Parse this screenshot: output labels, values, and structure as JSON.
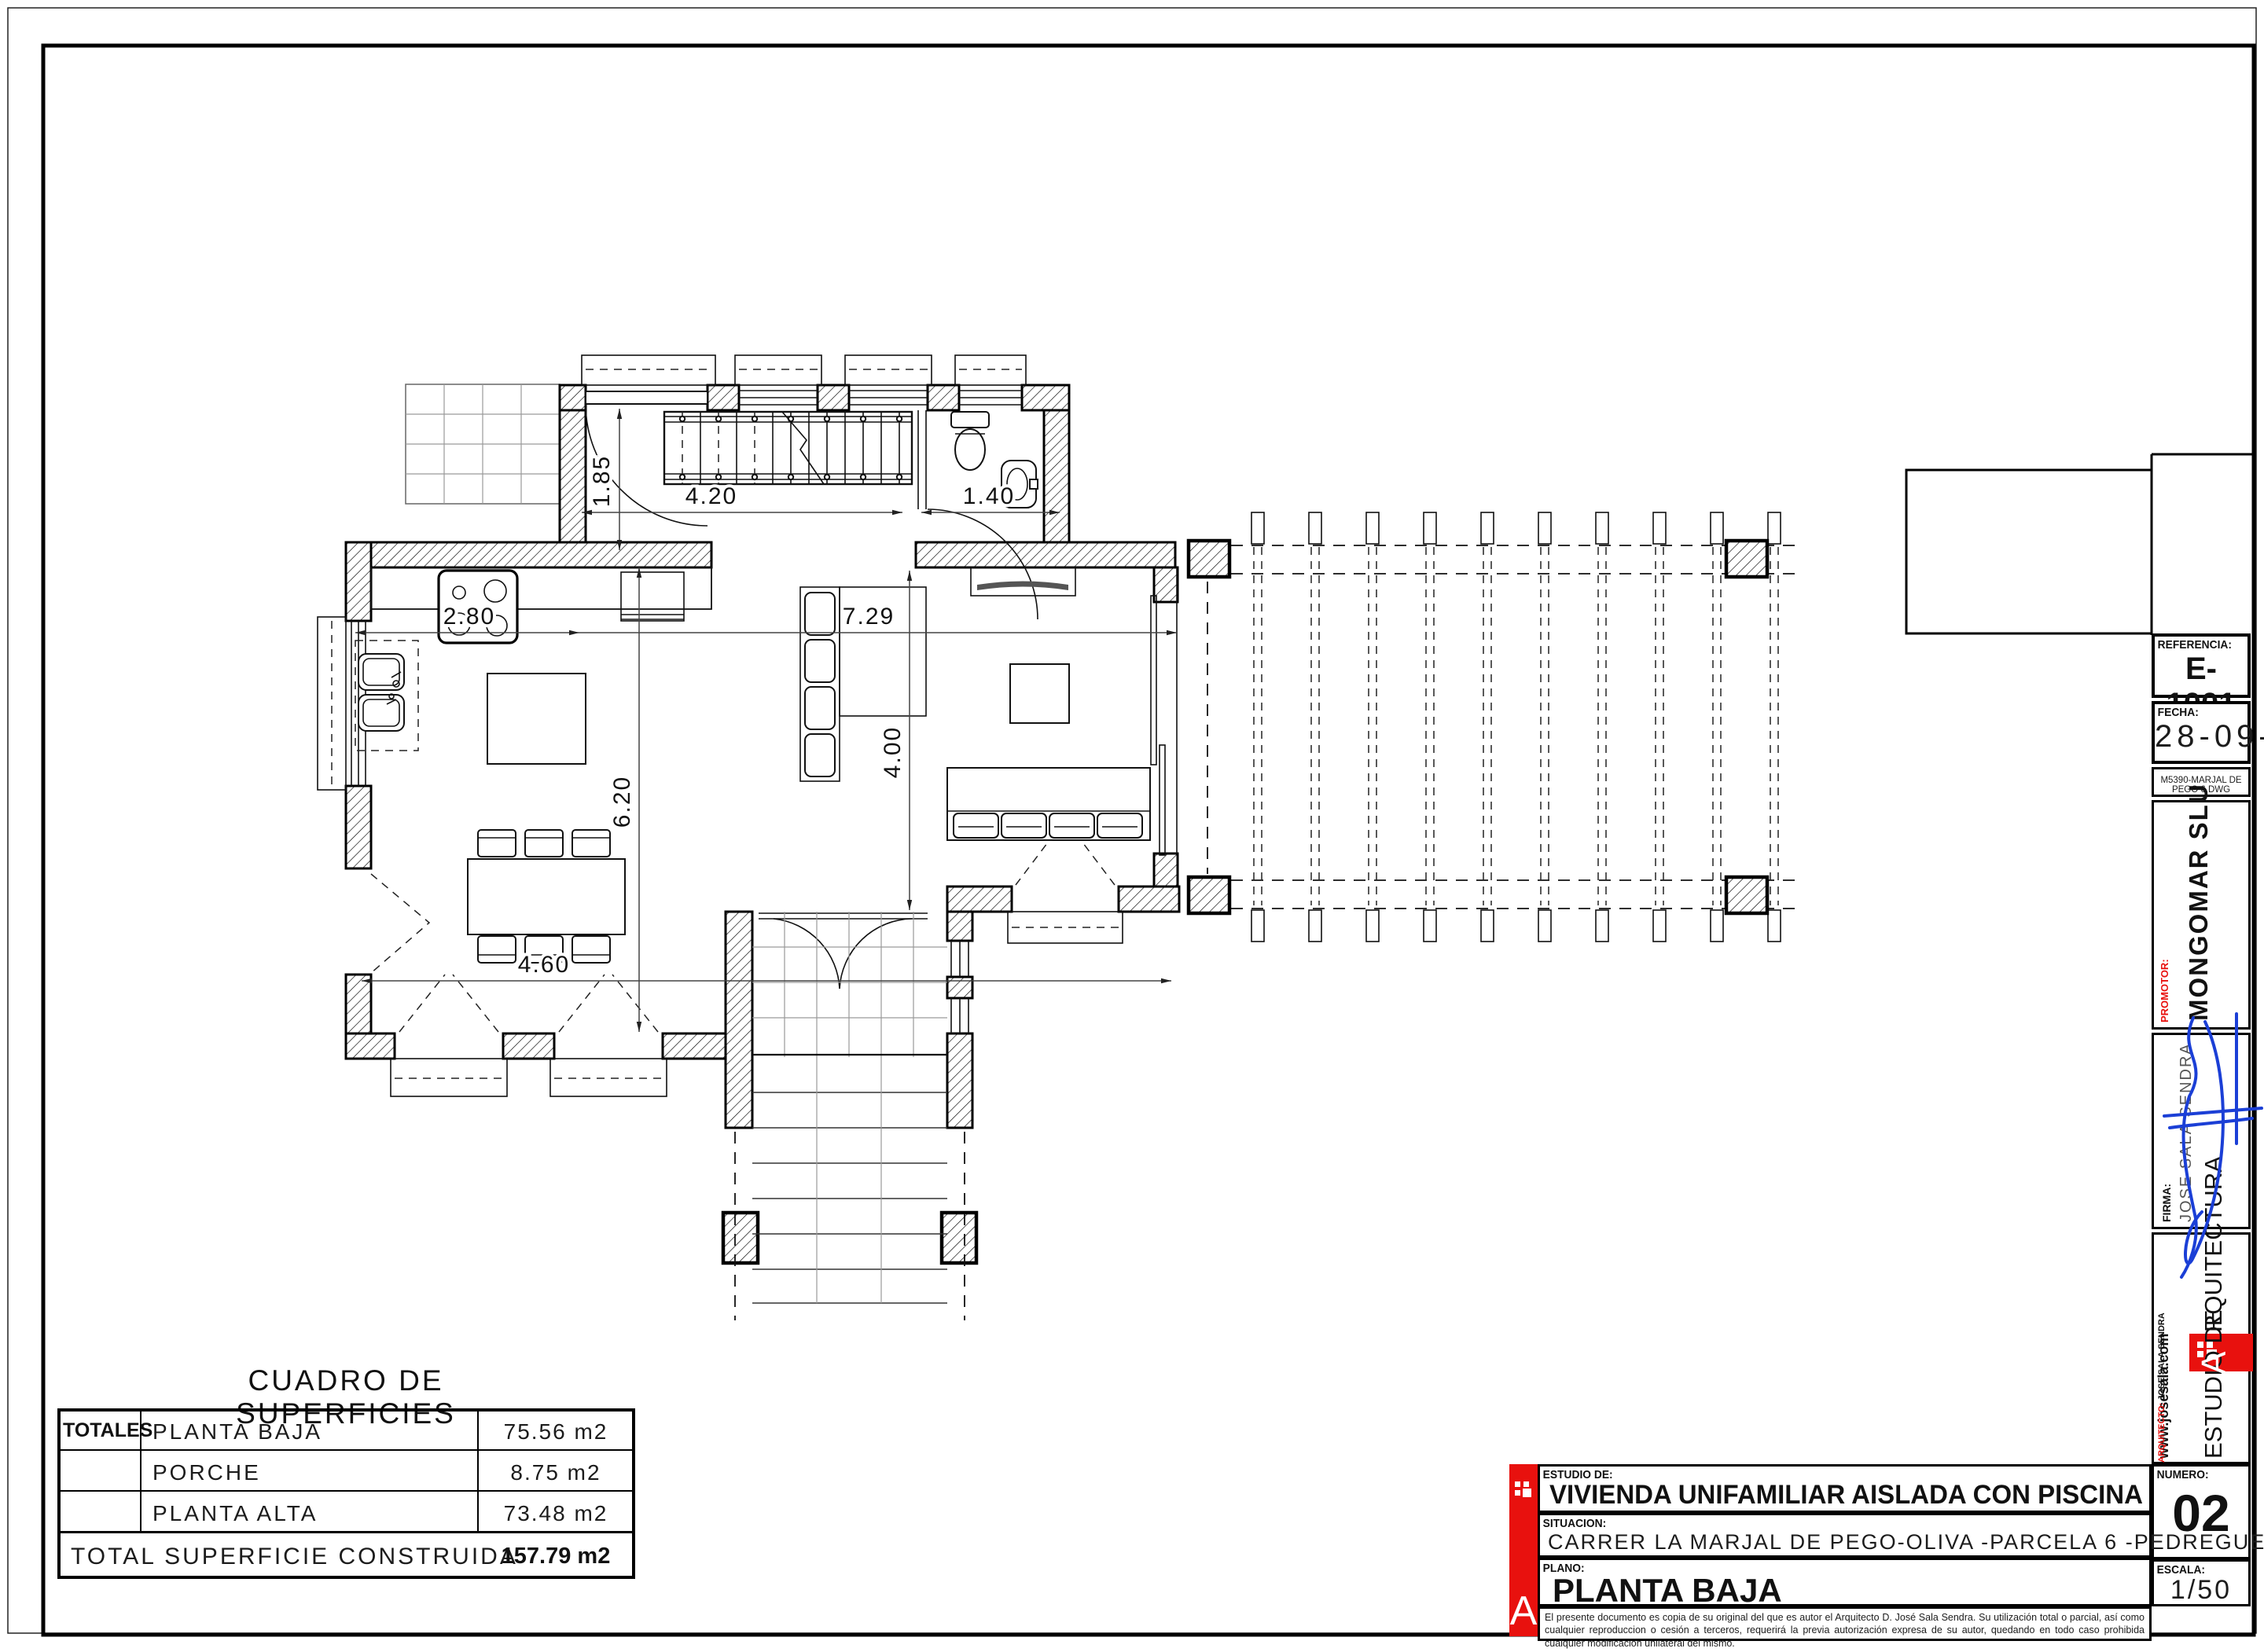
{
  "plan": {
    "dims": {
      "d185": "1.85",
      "d420": "4.20",
      "d140": "1.40",
      "d280": "2.80",
      "d729": "7.29",
      "d620": "6.20",
      "d400": "4.00",
      "d460": "4.60"
    }
  },
  "surfaces_table": {
    "title": "CUADRO DE SUPERFICIES",
    "totales_label": "TOTALES",
    "rows": [
      {
        "label": "PLANTA BAJA",
        "value": "75.56 m2"
      },
      {
        "label": "PORCHE",
        "value": "8.75 m2"
      },
      {
        "label": "PLANTA ALTA",
        "value": "73.48 m2"
      }
    ],
    "total_label": "TOTAL SUPERFICIE CONSTRUIDA",
    "total_value": "157.79 m2"
  },
  "title_block": {
    "referencia_label": "REFERENCIA:",
    "referencia": "E-1001",
    "fecha_label": "FECHA:",
    "fecha": "28-09-23",
    "file_name": "M5390-MARJAL DE PEGO 6.DWG",
    "promotor_label": "PROMOTOR:",
    "promotor": "MONGOMAR SLU",
    "firma_label": "FIRMA:",
    "firma": "JOSE SALA SENDRA",
    "website": "www.josesala.com",
    "studio_bottom": "ESTUDIO DE ",
    "studio_a": "A",
    "studio_top": "RQUITECTURA",
    "arquitecto_label": "ARQUITECTO:",
    "arquitecto": "JOSE SALA SENDRA",
    "numero_label": "NUMERO:",
    "numero": "02",
    "estudio_de_label": "ESTUDIO DE:",
    "project_title": "VIVIENDA UNIFAMILIAR AISLADA CON PISCINA",
    "situacion_label": "SITUACION:",
    "situacion": "CARRER LA MARJAL DE PEGO-OLIVA -PARCELA 6  -PEDREGUER-",
    "plano_label": "PLANO:",
    "plano": "PLANTA BAJA",
    "escala_label": "ESCALA:",
    "escala": "1/50",
    "logo_letter": "A",
    "disclaimer": "El presente documento es copia de su original del que es autor el Arquitecto D. José Sala Sendra. Su utilización total o parcial, así como cualquier reproduccion o cesión a terceros, requerirá la previa autorización expresa de su autor, quedando en todo caso prohibida cualquier modificación unilateral del mismo.",
    "colors": {
      "accent_red": "#e8110e",
      "signature_blue": "#1b3fd6"
    }
  }
}
